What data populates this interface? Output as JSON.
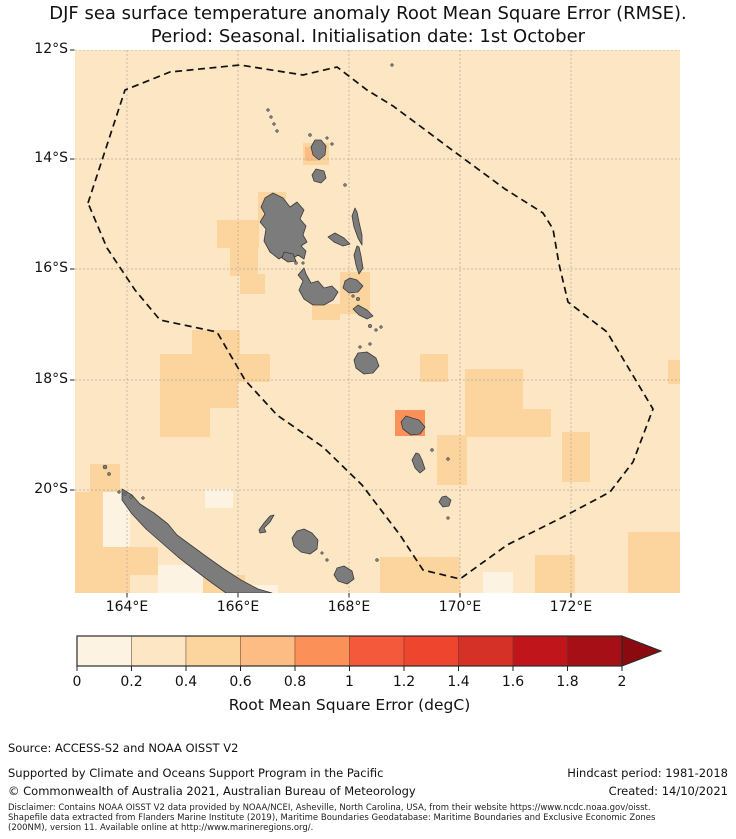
{
  "figure": {
    "title_line1": "DJF sea surface temperature anomaly Root Mean Square Error (RMSE).",
    "title_line2": "Period: Seasonal. Initialisation date: 1st October"
  },
  "map": {
    "width": 605,
    "height": 543,
    "lat_ticks": [
      {
        "label": "12°S",
        "y": 0
      },
      {
        "label": "14°S",
        "y": 109
      },
      {
        "label": "16°S",
        "y": 219
      },
      {
        "label": "18°S",
        "y": 330
      },
      {
        "label": "20°S",
        "y": 440
      }
    ],
    "lon_ticks": [
      {
        "label": "164°E",
        "x": 52
      },
      {
        "label": "166°E",
        "x": 163
      },
      {
        "label": "168°E",
        "x": 274
      },
      {
        "label": "170°E",
        "x": 385
      },
      {
        "label": "172°E",
        "x": 496
      }
    ],
    "ocean_color_index": 1,
    "land_color": "#7c7c7c",
    "land_edge": "#3b3b3b",
    "grid_color": "#b3a89c",
    "eez_color": "#101010",
    "eez_points": "13,153 50,40 95,22 165,15 228,25 262,17 292,40 318,56 345,76 373,97 430,139 468,163 478,179 484,214 493,252 532,282 578,359 558,412 535,442 488,467 432,495 385,529 348,520 325,485 287,435 248,397 202,365 170,330 142,282 85,270 60,240 32,198",
    "cells": [
      [
        228,
        93,
        26,
        22,
        2
      ],
      [
        183,
        142,
        28,
        28,
        2
      ],
      [
        142,
        170,
        42,
        28,
        2
      ],
      [
        155,
        198,
        28,
        28,
        2
      ],
      [
        165,
        224,
        25,
        20,
        2
      ],
      [
        265,
        222,
        30,
        42,
        2
      ],
      [
        237,
        254,
        28,
        16,
        2
      ],
      [
        117,
        280,
        48,
        26,
        2
      ],
      [
        85,
        304,
        110,
        28,
        2
      ],
      [
        85,
        330,
        50,
        57,
        2
      ],
      [
        135,
        332,
        28,
        26,
        2
      ],
      [
        345,
        304,
        28,
        28,
        2
      ],
      [
        390,
        319,
        58,
        68,
        2
      ],
      [
        448,
        359,
        28,
        28,
        2
      ],
      [
        362,
        385,
        30,
        50,
        2
      ],
      [
        487,
        382,
        28,
        50,
        2
      ],
      [
        460,
        505,
        40,
        40,
        2
      ],
      [
        553,
        482,
        52,
        63,
        2
      ],
      [
        305,
        507,
        80,
        38,
        2
      ],
      [
        15,
        414,
        30,
        28,
        2
      ],
      [
        0,
        442,
        28,
        103,
        2
      ],
      [
        28,
        497,
        27,
        48,
        2
      ],
      [
        55,
        497,
        28,
        28,
        2
      ],
      [
        100,
        525,
        70,
        20,
        2
      ],
      [
        593,
        310,
        12,
        24,
        2
      ],
      [
        130,
        439,
        28,
        19,
        0
      ],
      [
        28,
        442,
        27,
        55,
        0
      ],
      [
        83,
        515,
        45,
        30,
        0
      ],
      [
        168,
        535,
        35,
        10,
        0
      ],
      [
        408,
        522,
        30,
        23,
        0
      ],
      [
        230,
        97,
        12,
        14,
        3
      ],
      [
        320,
        360,
        30,
        26,
        4
      ]
    ],
    "islands": [
      {
        "name": "vanua-lava",
        "d": "M240,90 L236,97 L238,105 L244,110 L250,105 L251,96 L246,90 Z"
      },
      {
        "name": "gaua",
        "d": "M241,119 L237,125 L239,131 L246,133 L251,128 L249,121 Z"
      },
      {
        "name": "espiritu-santo",
        "d": "M198,143 L190,148 L186,157 L190,164 L185,172 L191,179 L189,191 L195,202 L204,209 L211,204 L217,209 L223,205 L229,209 L231,201 L226,196 L232,192 L228,185 L231,176 L225,169 L229,160 L222,152 L215,157 L208,148 Z"
      },
      {
        "name": "malo",
        "d": "M209,202 L207,208 L213,212 L221,211 L218,204 Z"
      },
      {
        "name": "maewo",
        "d": "M280,158 L277,166 L279,177 L283,188 L287,195 L287,185 L284,172 L282,162 Z"
      },
      {
        "name": "ambae",
        "d": "M253,187 L259,192 L268,196 L275,194 L269,188 L260,183 Z"
      },
      {
        "name": "pentecost",
        "d": "M282,196 L279,205 L281,215 L284,224 L288,218 L286,206 L284,197 Z"
      },
      {
        "name": "malekula",
        "d": "M229,218 L223,225 L228,231 L224,240 L229,249 L238,255 L249,255 L258,250 L263,242 L257,236 L249,238 L243,231 L236,233 L231,224 Z"
      },
      {
        "name": "ambrym",
        "d": "M270,231 L268,238 L274,243 L283,242 L288,236 L282,230 L275,228 Z"
      },
      {
        "name": "epi",
        "d": "M278,259 L284,265 L292,269 L298,266 L292,260 L283,255 Z"
      },
      {
        "name": "efate",
        "d": "M283,303 L279,310 L281,318 L289,324 L298,323 L304,316 L301,308 L292,302 Z"
      },
      {
        "name": "erromango",
        "d": "M331,366 L326,372 L328,379 L336,385 L345,384 L350,377 L344,370 L337,368 Z"
      },
      {
        "name": "tanna",
        "d": "M341,403 L337,410 L340,418 L345,423 L350,419 L347,410 L344,404 Z"
      },
      {
        "name": "aneityum",
        "d": "M367,447 L364,452 L368,457 L374,456 L376,450 L371,446 Z"
      },
      {
        "name": "new-caledonia",
        "d": "M47,439 L57,445 L65,454 L79,463 L93,474 L102,485 L117,496 L132,507 L149,519 L166,530 L183,539 L197,543 L151,543 L137,533 L121,521 L103,507 L87,493 L71,479 L57,464 L47,450 Z"
      },
      {
        "name": "ouvea",
        "d": "M184,480 L189,473 L195,466 L199,465 L195,472 L189,478 L191,482 L185,483 Z"
      },
      {
        "name": "lifou",
        "d": "M222,481 L217,488 L219,496 L226,502 L235,504 L242,499 L243,490 L237,483 L229,479 Z"
      },
      {
        "name": "mare",
        "d": "M262,518 L259,525 L263,531 L272,534 L279,529 L277,521 L269,516 Z"
      }
    ],
    "islets": [
      [
        193,
        60,
        1.4
      ],
      [
        196,
        67,
        1.4
      ],
      [
        199,
        74,
        1.4
      ],
      [
        202,
        81,
        1.4
      ],
      [
        317,
        15,
        1.4
      ],
      [
        235,
        85,
        1.5
      ],
      [
        252,
        88,
        1.3
      ],
      [
        257,
        94,
        1.4
      ],
      [
        270,
        135,
        1.5
      ],
      [
        221,
        213,
        1.5
      ],
      [
        228,
        213,
        1.3
      ],
      [
        278,
        246,
        1.4
      ],
      [
        283,
        249,
        1.8
      ],
      [
        295,
        276,
        1.8
      ],
      [
        301,
        280,
        1.4
      ],
      [
        306,
        277,
        1.4
      ],
      [
        285,
        297,
        1.4
      ],
      [
        295,
        294,
        1.4
      ],
      [
        357,
        400,
        1.5
      ],
      [
        373,
        409,
        1.5
      ],
      [
        373,
        468,
        1.4
      ],
      [
        302,
        510,
        1.5
      ],
      [
        30,
        417,
        2
      ],
      [
        34,
        424,
        1.6
      ],
      [
        44,
        442,
        1.4
      ],
      [
        50,
        444,
        1.4
      ],
      [
        56,
        447,
        1.4
      ],
      [
        68,
        448,
        1.4
      ],
      [
        252,
        510,
        1.4
      ],
      [
        247,
        503,
        1.3
      ]
    ]
  },
  "colorbar": {
    "colors": [
      "#fdf3e2",
      "#fce6c4",
      "#fcd49e",
      "#fdbc84",
      "#fb9159",
      "#f4593c",
      "#ee452f",
      "#d63127",
      "#c0161b",
      "#a50f15"
    ],
    "over_color": "#8b0a10",
    "tick_labels": [
      "0",
      "0.2",
      "0.4",
      "0.6",
      "0.8",
      "1",
      "1.2",
      "1.4",
      "1.6",
      "1.8",
      "2"
    ],
    "label": "Root Mean Square Error (degC)",
    "outline_color": "#2b2b2b"
  },
  "footer": {
    "source": "Source: ACCESS-S2 and NOAA OISST V2",
    "supported": "Supported by Climate and Oceans Support Program in the Pacific",
    "copyright": "© Commonwealth of Australia 2021, Australian Bureau of Meteorology",
    "hindcast": "Hindcast period: 1981-2018",
    "created": "Created: 14/10/2021",
    "disclaimer_lines": [
      "Disclaimer: Contains NOAA OISST V2 data provided by NOAA/NCEI, Asheville, North Carolina, USA, from their website https://www.ncdc.noaa.gov/oisst.",
      "Shapefile data extracted from Flanders Marine Institute (2019), Maritime Boundaries Geodatabase: Maritime Boundaries and Exclusive Economic Zones",
      "(200NM), version 11. Available online at http://www.marineregions.org/."
    ]
  },
  "chart_data": {
    "type": "heatmap",
    "title": "DJF sea surface temperature anomaly Root Mean Square Error (RMSE). Period: Seasonal. Initialisation date: 1st October",
    "xlabel": "Longitude",
    "ylabel": "Latitude",
    "x_tick_labels": [
      "164°E",
      "166°E",
      "168°E",
      "170°E",
      "172°E"
    ],
    "y_tick_labels": [
      "12°S",
      "14°S",
      "16°S",
      "18°S",
      "20°S"
    ],
    "colorbar_label": "Root Mean Square Error (degC)",
    "colorbar_ticks": [
      0,
      0.2,
      0.4,
      0.6,
      0.8,
      1,
      1.2,
      1.4,
      1.6,
      1.8,
      2
    ],
    "value_range_shown": [
      0,
      2
    ],
    "dominant_value_bin": "0.2-0.4",
    "notes": "Most of the Vanuatu/New Caledonia EEZ region shows RMSE 0.2-0.4 degC; scattered 0.4-0.6 patches; ~0.8-1.0 cell near Erromango; a few 0-0.2 cells near New Caledonia."
  }
}
